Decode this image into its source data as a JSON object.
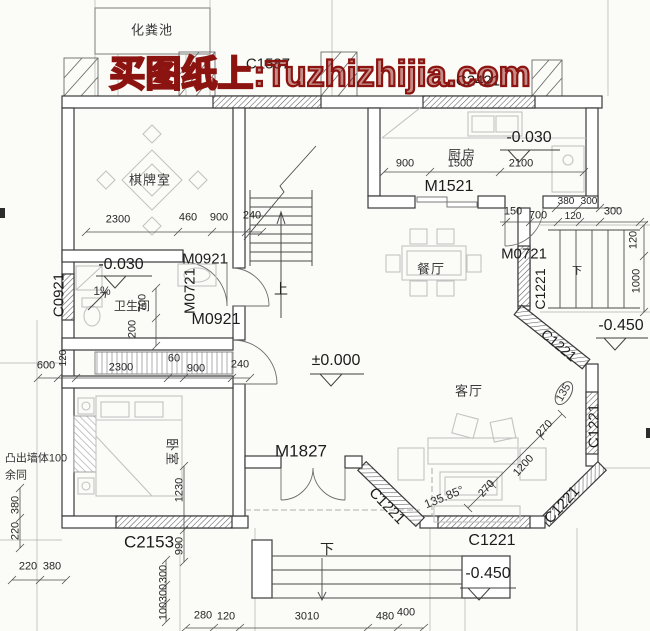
{
  "watermark": {
    "text": "买图纸上:Tuzhizhijia.com",
    "color": "#8c1410"
  },
  "rooms": {
    "septic": "化粪池",
    "chess": "棋牌室",
    "kitchen": "厨房",
    "bath": "卫生间",
    "dining": "餐厅",
    "living": "客厅",
    "bedroom": "卧室"
  },
  "stairs": {
    "up": "上",
    "down_front": "下",
    "down_side": "下"
  },
  "elevations": {
    "kitchen": "-0.030",
    "bath": "-0.030",
    "main": "±0.000",
    "right": "-0.450",
    "front": "-0.450"
  },
  "openings": {
    "c1587": "C1587",
    "c2421": "C2421",
    "m1521": "M1521",
    "m0921_chess": "M0921",
    "m0721_bath": "M0721",
    "m0921_bed": "M0921",
    "c0921": "C0921",
    "c2153": "C2153",
    "m1827": "M1827",
    "m0721_side": "M0721",
    "c1221_side": "C1221",
    "c1221_ne": "C1221",
    "c1221_e": "C1221",
    "c1221_se": "C1221",
    "c1221_s": "C1221",
    "c1221_sw": "C1221"
  },
  "notes": {
    "slope": "1%",
    "protrude": "凸出墙体100",
    "same": "余同",
    "angle_sw": "135.85°",
    "angle_e": "135"
  },
  "dims": {
    "chess": [
      "2300",
      "460",
      "900",
      "240"
    ],
    "mid": [
      "600",
      "120",
      "2300",
      "60",
      "900",
      "240"
    ],
    "kitchen": [
      "900",
      "1500",
      "2100"
    ],
    "kitchen_sub": [
      "380",
      "300",
      "150",
      "700",
      "120",
      "300"
    ],
    "right": [
      "120",
      "1000"
    ],
    "bath": [
      "700",
      "200"
    ],
    "bedroom": [
      "1230",
      "990"
    ],
    "left": [
      "380",
      "220"
    ],
    "left_bottom": [
      "220",
      "380"
    ],
    "steps": [
      "300",
      "300",
      "100"
    ],
    "bottom": [
      "280",
      "120",
      "3010",
      "480",
      "400"
    ],
    "bay": [
      "270",
      "1200",
      "270"
    ]
  }
}
